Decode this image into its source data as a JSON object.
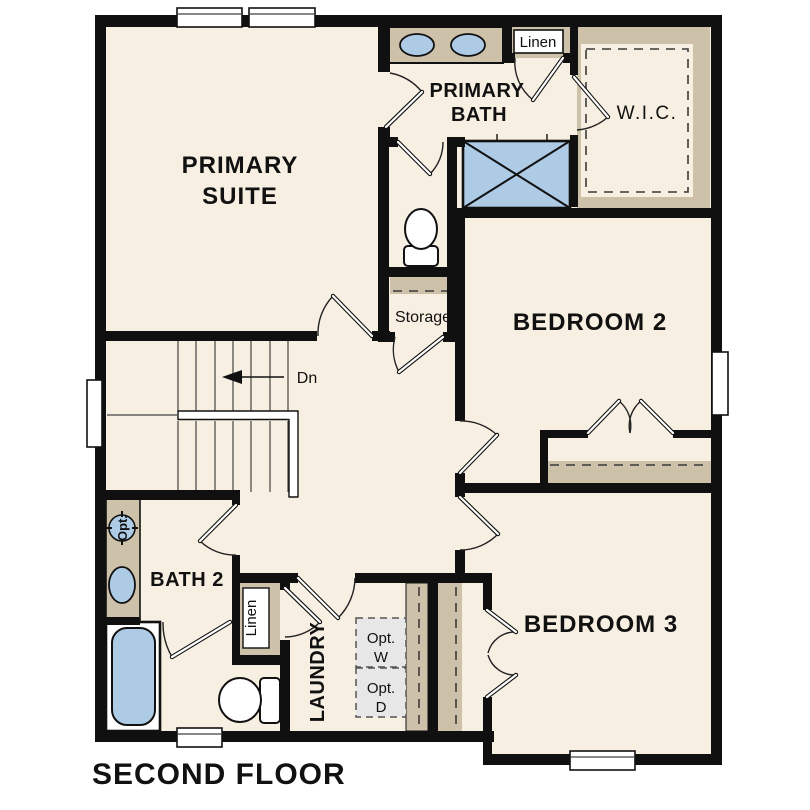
{
  "plan": {
    "floor_title": "SECOND FLOOR",
    "labels": {
      "primary_suite_1": "PRIMARY",
      "primary_suite_2": "SUITE",
      "primary_bath_1": "PRIMARY",
      "primary_bath_2": "BATH",
      "wic": "W.I.C.",
      "linen_upper": "Linen",
      "bedroom_2": "BEDROOM 2",
      "storage": "Storage",
      "stairs_down": "Dn",
      "bath_2": "BATH 2",
      "linen_lower": "Linen",
      "laundry": "LAUNDRY",
      "opt_washer_1": "Opt.",
      "opt_washer_2": "W",
      "opt_dryer_1": "Opt.",
      "opt_dryer_2": "D",
      "opt_sink": "Opt.",
      "bedroom_3": "BEDROOM 3"
    },
    "colors": {
      "floor": "#f7efe2",
      "wall": "#101010",
      "shelving_tan": "#cdc2a9",
      "fixture_blue": "#aecbe6",
      "optional_appliance_gray": "#e7e7e7"
    }
  }
}
